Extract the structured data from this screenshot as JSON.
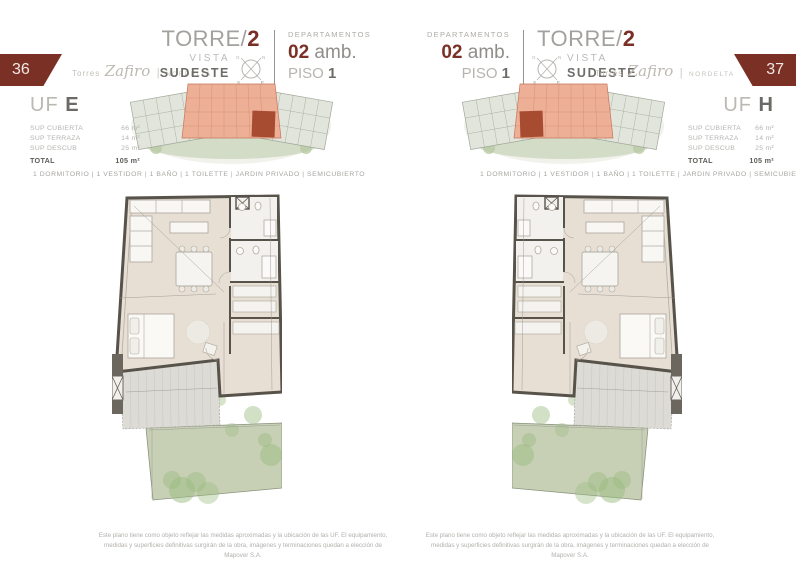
{
  "colors": {
    "accent_maroon": "#7b3026",
    "floor_beige": "#e7dfd4",
    "wall_gray": "#57534b",
    "garden_green": "#c7d0b5",
    "terrace_gray": "#dcdbd6",
    "highlight_unit_red": "#a74b31",
    "map_salmon": "#edaf96"
  },
  "compass": {
    "n": "N",
    "e": "E",
    "s": "S",
    "o": "O"
  },
  "left": {
    "page_number": "36",
    "brand": {
      "torres": "Torres",
      "zafiro": "Zafiro",
      "sep": "|",
      "nordelta": "NORDELTA"
    },
    "title": {
      "torre": "TORRE/",
      "num": "2",
      "vista": "VISTA",
      "orientation": "SUDESTE"
    },
    "dept": {
      "label": "DEPARTAMENTOS",
      "rooms": "02",
      "rooms_suffix": " amb.",
      "piso": "PISO ",
      "piso_num": "1"
    },
    "unit": {
      "uf": "UF ",
      "letter": "E",
      "rows": [
        {
          "label": "SUP CUBIERTA",
          "value": "66 m²"
        },
        {
          "label": "SUP TERRAZA",
          "value": "14 m²"
        },
        {
          "label": "SUP DESCUB",
          "value": "25 m²"
        }
      ],
      "total_label": "TOTAL",
      "total_value": "105 m²"
    },
    "amenities": "1 DORMITORIO | 1 VESTIDOR | 1 BAÑO | 1 TOILETTE | JARDIN PRIVADO | SEMICUBIERTO",
    "disclaimer": "Este plano tiene como objeto reflejar las medidas aproximadas y la ubicación de las UF. El equipamiento, medidas y superficies definitivas surgirán de la obra, imágenes y terminaciones quedan a elección de Mapover S.A."
  },
  "right": {
    "page_number": "37",
    "brand": {
      "torres": "Torres",
      "zafiro": "Zafiro",
      "sep": "|",
      "nordelta": "NORDELTA"
    },
    "title": {
      "torre": "TORRE/",
      "num": "2",
      "vista": "VISTA",
      "orientation": "SUDESTE"
    },
    "dept": {
      "label": "DEPARTAMENTOS",
      "rooms": "02",
      "rooms_suffix": " amb.",
      "piso": "PISO ",
      "piso_num": "1"
    },
    "unit": {
      "uf": "UF ",
      "letter": "H",
      "rows": [
        {
          "label": "SUP CUBIERTA",
          "value": "66 m²"
        },
        {
          "label": "SUP TERRAZA",
          "value": "14 m²"
        },
        {
          "label": "SUP DESCUB",
          "value": "25 m²"
        }
      ],
      "total_label": "TOTAL",
      "total_value": "105 m²"
    },
    "amenities": "1 DORMITORIO | 1 VESTIDOR | 1 BAÑO | 1 TOILETTE | JARDIN PRIVADO | SEMICUBIERTO",
    "disclaimer": "Este plano tiene como objeto reflejar las medidas aproximadas y la ubicación de las UF. El equipamiento, medidas y superficies definitivas surgirán de la obra, imágenes y terminaciones quedan a elección de Mapover S.A."
  }
}
